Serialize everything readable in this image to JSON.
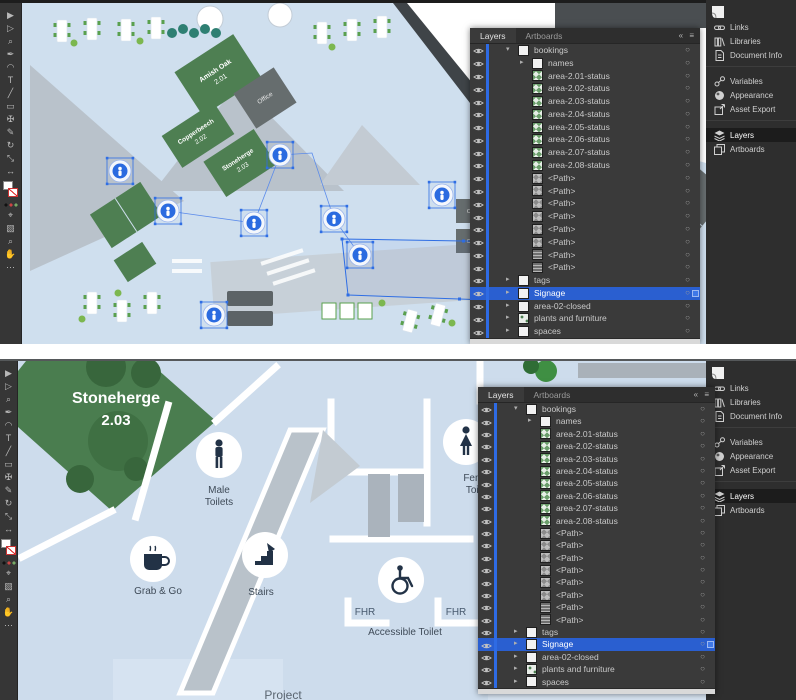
{
  "app": {
    "accent": "#2f6ee4",
    "selection_blue": "#2f6ee4"
  },
  "dock": {
    "items": [
      {
        "label": "Links",
        "icon": "links-icon"
      },
      {
        "label": "Libraries",
        "icon": "libraries-icon"
      },
      {
        "label": "Document Info",
        "icon": "document-info-icon"
      },
      {
        "label": "Variables",
        "icon": "variables-icon",
        "gap": true
      },
      {
        "label": "Appearance",
        "icon": "appearance-icon"
      },
      {
        "label": "Asset Export",
        "icon": "asset-export-icon"
      },
      {
        "label": "Layers",
        "icon": "layers-icon",
        "active": true,
        "gap": true
      },
      {
        "label": "Artboards",
        "icon": "artboards-icon"
      }
    ]
  },
  "layers_panel": {
    "tabs": [
      "Layers",
      "Artboards"
    ],
    "active_tab": "Layers",
    "menu_glyphs": "« ≡",
    "rows": [
      {
        "label": "bookings",
        "kind": "group",
        "thumb": "white",
        "indent": 0,
        "arrow": "expanded"
      },
      {
        "label": "names",
        "kind": "group",
        "thumb": "white",
        "indent": 1,
        "arrow": "collapsed"
      },
      {
        "label": "area-2.01-status",
        "kind": "item",
        "thumb": "green",
        "indent": 1
      },
      {
        "label": "area-2.02-status",
        "kind": "item",
        "thumb": "green",
        "indent": 1
      },
      {
        "label": "area-2.03-status",
        "kind": "item",
        "thumb": "green",
        "indent": 1
      },
      {
        "label": "area-2.04-status",
        "kind": "item",
        "thumb": "green",
        "indent": 1
      },
      {
        "label": "area-2.05-status",
        "kind": "item",
        "thumb": "green",
        "indent": 1
      },
      {
        "label": "area-2.06-status",
        "kind": "item",
        "thumb": "green",
        "indent": 1
      },
      {
        "label": "area-2.07-status",
        "kind": "item",
        "thumb": "green",
        "indent": 1
      },
      {
        "label": "area-2.08-status",
        "kind": "item",
        "thumb": "green",
        "indent": 1
      },
      {
        "label": "<Path>",
        "kind": "item",
        "thumb": "checker",
        "indent": 1
      },
      {
        "label": "<Path>",
        "kind": "item",
        "thumb": "checker",
        "indent": 1
      },
      {
        "label": "<Path>",
        "kind": "item",
        "thumb": "checker",
        "indent": 1
      },
      {
        "label": "<Path>",
        "kind": "item",
        "thumb": "checker",
        "indent": 1
      },
      {
        "label": "<Path>",
        "kind": "item",
        "thumb": "checker",
        "indent": 1
      },
      {
        "label": "<Path>",
        "kind": "item",
        "thumb": "checker",
        "indent": 1
      },
      {
        "label": "<Path>",
        "kind": "item",
        "thumb": "stripes",
        "indent": 1
      },
      {
        "label": "<Path>",
        "kind": "item",
        "thumb": "stripes",
        "indent": 1
      },
      {
        "label": "tags",
        "kind": "group",
        "thumb": "white",
        "indent": 0,
        "arrow": "collapsed"
      },
      {
        "label": "Signage",
        "kind": "group",
        "thumb": "white",
        "indent": 0,
        "arrow": "collapsed",
        "selected": true
      },
      {
        "label": "area-02-closed",
        "kind": "group",
        "thumb": "white",
        "indent": 0,
        "arrow": "collapsed"
      },
      {
        "label": "plants and furniture",
        "kind": "group",
        "thumb": "plants",
        "indent": 0,
        "arrow": "collapsed"
      },
      {
        "label": "spaces",
        "kind": "group",
        "thumb": "white",
        "indent": 0,
        "arrow": "collapsed"
      }
    ]
  },
  "maps": {
    "top": {
      "rooms": [
        {
          "name": "Amish Oak",
          "number": "2.01"
        },
        {
          "name": "Copperbeech",
          "number": "2.02"
        },
        {
          "name": "Stoneherge",
          "number": "2.03"
        }
      ],
      "office_label": "Office"
    },
    "bottom": {
      "room": {
        "name": "Stoneherge",
        "number": "2.03"
      },
      "male": [
        "Male",
        "Toilets"
      ],
      "female": [
        "Female",
        "Toilets"
      ],
      "grab": "Grab & Go",
      "stairs": "Stairs",
      "fhr": "FHR",
      "accessible": "Accessible Toilet",
      "project": "Project"
    }
  },
  "toolbar": {
    "tools": [
      "selection-tool-icon",
      "direct-selection-tool-icon",
      "magic-wand-tool-icon",
      "pen-tool-icon",
      "curvature-tool-icon",
      "type-tool-icon",
      "line-tool-icon",
      "rectangle-tool-icon",
      "paintbrush-tool-icon",
      "pencil-tool-icon",
      "rotate-tool-icon",
      "scale-tool-icon",
      "width-tool-icon",
      "eyedropper-tool-icon",
      "gradient-tool-icon",
      "zoom-tool-icon",
      "hand-tool-icon"
    ],
    "glyphs": [
      "▶",
      "▷",
      "⌕",
      "✒",
      "◠",
      "T",
      "╱",
      "▭",
      "✠",
      "✎",
      "↻",
      "⤡",
      "↔",
      "⌖",
      "▧",
      "⌕",
      "✋"
    ]
  }
}
